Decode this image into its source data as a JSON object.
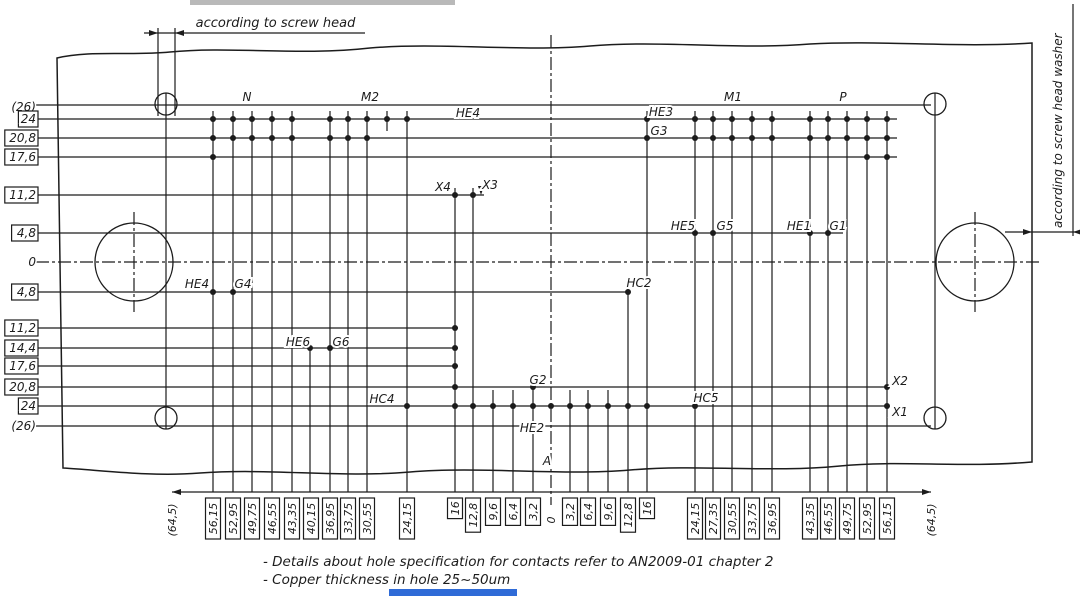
{
  "drawing": {
    "top_note": "according to screw head",
    "right_note": "according to screw head washer",
    "notes": [
      "- Details about hole specification for contacts refer to AN2009-01 chapter 2",
      "- Copper thickness in hole 25~50um"
    ],
    "ink": "#1c1c1c",
    "artifact_colors": {
      "top_smudge": "#b9b9b9",
      "bottom_strip": "#2f6bd7"
    },
    "outline_path": "M57,58 C90,50 130,56 170,52 C230,46 300,56 370,48 C440,42 520,52 590,46 C660,40 740,50 810,44 C880,40 960,48 1032,43 L1032,462 C960,468 900,460 840,466 C770,473 700,464 630,470 C560,476 480,466 410,472 C340,478 270,468 200,473 C150,477 100,470 63,468 L57,58 Z",
    "h_lines": [
      {
        "y": 105,
        "x1": 36,
        "x2": 931
      },
      {
        "y": 119,
        "x1": 36,
        "x2": 897
      },
      {
        "y": 138,
        "x1": 36,
        "x2": 897
      },
      {
        "y": 157,
        "x1": 36,
        "x2": 897
      },
      {
        "y": 195,
        "x1": 36,
        "x2": 484
      },
      {
        "y": 233,
        "x1": 36,
        "x2": 843
      },
      {
        "y": 262,
        "x1": 36,
        "x2": 1040,
        "d": 1
      },
      {
        "y": 292,
        "x1": 36,
        "x2": 629
      },
      {
        "y": 328,
        "x1": 36,
        "x2": 458
      },
      {
        "y": 348,
        "x1": 36,
        "x2": 458
      },
      {
        "y": 366,
        "x1": 36,
        "x2": 458
      },
      {
        "y": 387,
        "x1": 36,
        "x2": 889
      },
      {
        "y": 406,
        "x1": 36,
        "x2": 889
      },
      {
        "y": 426,
        "x1": 36,
        "x2": 931
      },
      {
        "y": 33,
        "x1": 144,
        "x2": 365
      },
      {
        "y": 232,
        "x1": 1005,
        "x2": 1080
      },
      {
        "y": 492,
        "x1": 172,
        "x2": 931
      }
    ],
    "v_lines": [
      {
        "x": 213,
        "y1": 111,
        "y2": 492
      },
      {
        "x": 233,
        "y1": 111,
        "y2": 492
      },
      {
        "x": 252,
        "y1": 111,
        "y2": 492
      },
      {
        "x": 272,
        "y1": 111,
        "y2": 492
      },
      {
        "x": 292,
        "y1": 111,
        "y2": 492
      },
      {
        "x": 310,
        "y1": 342,
        "y2": 492
      },
      {
        "x": 330,
        "y1": 111,
        "y2": 492
      },
      {
        "x": 348,
        "y1": 111,
        "y2": 492
      },
      {
        "x": 367,
        "y1": 111,
        "y2": 492
      },
      {
        "x": 387,
        "y1": 111,
        "y2": 131
      },
      {
        "x": 407,
        "y1": 111,
        "y2": 492
      },
      {
        "x": 455,
        "y1": 188,
        "y2": 492
      },
      {
        "x": 473,
        "y1": 188,
        "y2": 492
      },
      {
        "x": 493,
        "y1": 390,
        "y2": 492
      },
      {
        "x": 513,
        "y1": 390,
        "y2": 492
      },
      {
        "x": 533,
        "y1": 376,
        "y2": 492
      },
      {
        "x": 570,
        "y1": 390,
        "y2": 492
      },
      {
        "x": 588,
        "y1": 390,
        "y2": 492
      },
      {
        "x": 608,
        "y1": 390,
        "y2": 492
      },
      {
        "x": 628,
        "y1": 286,
        "y2": 492
      },
      {
        "x": 647,
        "y1": 111,
        "y2": 492
      },
      {
        "x": 695,
        "y1": 111,
        "y2": 492
      },
      {
        "x": 713,
        "y1": 111,
        "y2": 492
      },
      {
        "x": 732,
        "y1": 111,
        "y2": 492
      },
      {
        "x": 752,
        "y1": 111,
        "y2": 492
      },
      {
        "x": 772,
        "y1": 111,
        "y2": 492
      },
      {
        "x": 810,
        "y1": 111,
        "y2": 492
      },
      {
        "x": 828,
        "y1": 111,
        "y2": 492
      },
      {
        "x": 847,
        "y1": 111,
        "y2": 492
      },
      {
        "x": 867,
        "y1": 111,
        "y2": 492
      },
      {
        "x": 887,
        "y1": 111,
        "y2": 492
      },
      {
        "x": 166,
        "y1": 93,
        "y2": 429
      },
      {
        "x": 935,
        "y1": 93,
        "y2": 429
      },
      {
        "x": 158,
        "y1": 28,
        "y2": 116
      },
      {
        "x": 175,
        "y1": 28,
        "y2": 116
      },
      {
        "x": 1073,
        "y1": 4,
        "y2": 236
      },
      {
        "x": 551,
        "y1": 35,
        "y2": 505,
        "d": 1
      },
      {
        "x": 134,
        "y1": 212,
        "y2": 312,
        "d": 1
      },
      {
        "x": 975,
        "y1": 212,
        "y2": 312,
        "d": 1
      }
    ],
    "dot_rows": [
      {
        "y": 119,
        "xs": [
          213,
          233,
          252,
          272,
          292,
          330,
          348,
          367,
          387,
          407,
          647,
          695,
          713,
          732,
          752,
          772,
          810,
          828,
          847,
          867,
          887
        ]
      },
      {
        "y": 138,
        "xs": [
          213,
          233,
          252,
          272,
          292,
          330,
          348,
          367,
          647,
          695,
          713,
          732,
          752,
          772,
          810,
          828,
          847,
          867,
          887
        ]
      },
      {
        "y": 157,
        "xs": [
          213,
          867,
          887
        ]
      },
      {
        "y": 195,
        "xs": [
          455,
          473
        ]
      },
      {
        "y": 233,
        "xs": [
          695,
          713,
          810,
          828
        ]
      },
      {
        "y": 292,
        "xs": [
          213,
          233,
          628
        ]
      },
      {
        "y": 328,
        "xs": [
          455
        ]
      },
      {
        "y": 348,
        "xs": [
          310,
          330,
          455
        ]
      },
      {
        "y": 366,
        "xs": [
          455
        ]
      },
      {
        "y": 387,
        "xs": [
          455,
          533,
          887
        ]
      },
      {
        "y": 406,
        "xs": [
          407,
          455,
          473,
          493,
          513,
          533,
          551,
          570,
          588,
          608,
          628,
          647,
          695,
          887
        ]
      }
    ],
    "circles": [
      {
        "cx": 166,
        "cy": 104,
        "r": 11,
        "name": "screw-head-hole"
      },
      {
        "cx": 935,
        "cy": 104,
        "r": 11,
        "name": "screw-hole-top-right"
      },
      {
        "cx": 166,
        "cy": 418,
        "r": 11,
        "name": "screw-hole-bottom-left"
      },
      {
        "cx": 935,
        "cy": 418,
        "r": 11,
        "name": "screw-hole-bottom-right"
      },
      {
        "cx": 134,
        "cy": 262,
        "r": 39,
        "name": "mounting-hole-left"
      },
      {
        "cx": 975,
        "cy": 262,
        "r": 39,
        "name": "mounting-hole-right"
      }
    ],
    "arrows": [
      {
        "x": 158,
        "y": 33,
        "o": "r"
      },
      {
        "x": 175,
        "y": 33,
        "o": "l"
      },
      {
        "x": 1032,
        "y": 232,
        "o": "r"
      },
      {
        "x": 1073,
        "y": 232,
        "o": "l"
      },
      {
        "x": 172,
        "y": 492,
        "o": "l"
      },
      {
        "x": 931,
        "y": 492,
        "o": "r"
      },
      {
        "x": 481,
        "y": 195,
        "o": "d"
      }
    ],
    "point_labels": [
      {
        "t": "N",
        "x": 247,
        "y": 97
      },
      {
        "t": "M2",
        "x": 370,
        "y": 97
      },
      {
        "t": "M1",
        "x": 733,
        "y": 97
      },
      {
        "t": "P",
        "x": 843,
        "y": 97
      },
      {
        "t": "HE4",
        "x": 468,
        "y": 113
      },
      {
        "t": "HE3",
        "x": 661,
        "y": 112
      },
      {
        "t": "G3",
        "x": 659,
        "y": 131
      },
      {
        "t": "X4",
        "x": 443,
        "y": 187
      },
      {
        "t": "X3",
        "x": 490,
        "y": 185
      },
      {
        "t": "HE5",
        "x": 683,
        "y": 226
      },
      {
        "t": "G5",
        "x": 725,
        "y": 226
      },
      {
        "t": "HE1",
        "x": 799,
        "y": 226
      },
      {
        "t": "G1",
        "x": 838,
        "y": 226
      },
      {
        "t": "HE4",
        "x": 197,
        "y": 284
      },
      {
        "t": "G4",
        "x": 243,
        "y": 284
      },
      {
        "t": "HC2",
        "x": 639,
        "y": 283
      },
      {
        "t": "HE6",
        "x": 298,
        "y": 342
      },
      {
        "t": "G6",
        "x": 341,
        "y": 342
      },
      {
        "t": "G2",
        "x": 538,
        "y": 380
      },
      {
        "t": "HC4",
        "x": 382,
        "y": 399
      },
      {
        "t": "HC5",
        "x": 706,
        "y": 398
      },
      {
        "t": "HE2",
        "x": 532,
        "y": 428
      },
      {
        "t": "X2",
        "x": 900,
        "y": 381
      },
      {
        "t": "X1",
        "x": 900,
        "y": 412
      },
      {
        "t": "A",
        "x": 547,
        "y": 461
      }
    ],
    "left_labels": [
      {
        "t": "(26)",
        "y": 107,
        "boxed": false
      },
      {
        "t": "24",
        "y": 119,
        "boxed": true
      },
      {
        "t": "20,8",
        "y": 138,
        "boxed": true
      },
      {
        "t": "17,6",
        "y": 157,
        "boxed": true
      },
      {
        "t": "11,2",
        "y": 195,
        "boxed": true
      },
      {
        "t": "4,8",
        "y": 233,
        "boxed": true
      },
      {
        "t": "0",
        "y": 262,
        "boxed": false
      },
      {
        "t": "4,8",
        "y": 292,
        "boxed": true
      },
      {
        "t": "11,2",
        "y": 328,
        "boxed": true
      },
      {
        "t": "14,4",
        "y": 348,
        "boxed": true
      },
      {
        "t": "17,6",
        "y": 366,
        "boxed": true
      },
      {
        "t": "20,8",
        "y": 387,
        "boxed": true
      },
      {
        "t": "24",
        "y": 406,
        "boxed": true
      },
      {
        "t": "(26)",
        "y": 426,
        "boxed": false
      }
    ],
    "bottom_labels": [
      {
        "t": "(64,5)",
        "x": 172,
        "boxed": false
      },
      {
        "t": "56,15",
        "x": 213,
        "boxed": true
      },
      {
        "t": "52,95",
        "x": 233,
        "boxed": true
      },
      {
        "t": "49,75",
        "x": 252,
        "boxed": true
      },
      {
        "t": "46,55",
        "x": 272,
        "boxed": true
      },
      {
        "t": "43,35",
        "x": 292,
        "boxed": true
      },
      {
        "t": "40,15",
        "x": 311,
        "boxed": true
      },
      {
        "t": "36,95",
        "x": 330,
        "boxed": true
      },
      {
        "t": "33,75",
        "x": 348,
        "boxed": true
      },
      {
        "t": "30,55",
        "x": 367,
        "boxed": true
      },
      {
        "t": "24,15",
        "x": 407,
        "boxed": true
      },
      {
        "t": "16",
        "x": 455,
        "boxed": true
      },
      {
        "t": "12,8",
        "x": 473,
        "boxed": true
      },
      {
        "t": "9,6",
        "x": 493,
        "boxed": true
      },
      {
        "t": "6,4",
        "x": 513,
        "boxed": true
      },
      {
        "t": "3,2",
        "x": 533,
        "boxed": true
      },
      {
        "t": "0",
        "x": 551,
        "boxed": false
      },
      {
        "t": "3,2",
        "x": 570,
        "boxed": true
      },
      {
        "t": "6,4",
        "x": 588,
        "boxed": true
      },
      {
        "t": "9,6",
        "x": 608,
        "boxed": true
      },
      {
        "t": "12,8",
        "x": 628,
        "boxed": true
      },
      {
        "t": "16",
        "x": 647,
        "boxed": true
      },
      {
        "t": "24,15",
        "x": 695,
        "boxed": true
      },
      {
        "t": "27,35",
        "x": 713,
        "boxed": true
      },
      {
        "t": "30,55",
        "x": 732,
        "boxed": true
      },
      {
        "t": "33,75",
        "x": 752,
        "boxed": true
      },
      {
        "t": "36,95",
        "x": 772,
        "boxed": true
      },
      {
        "t": "43,35",
        "x": 810,
        "boxed": true
      },
      {
        "t": "46,55",
        "x": 828,
        "boxed": true
      },
      {
        "t": "49,75",
        "x": 847,
        "boxed": true
      },
      {
        "t": "52,95",
        "x": 867,
        "boxed": true
      },
      {
        "t": "56,15",
        "x": 887,
        "boxed": true
      },
      {
        "t": "(64,5)",
        "x": 931,
        "boxed": false
      }
    ]
  }
}
